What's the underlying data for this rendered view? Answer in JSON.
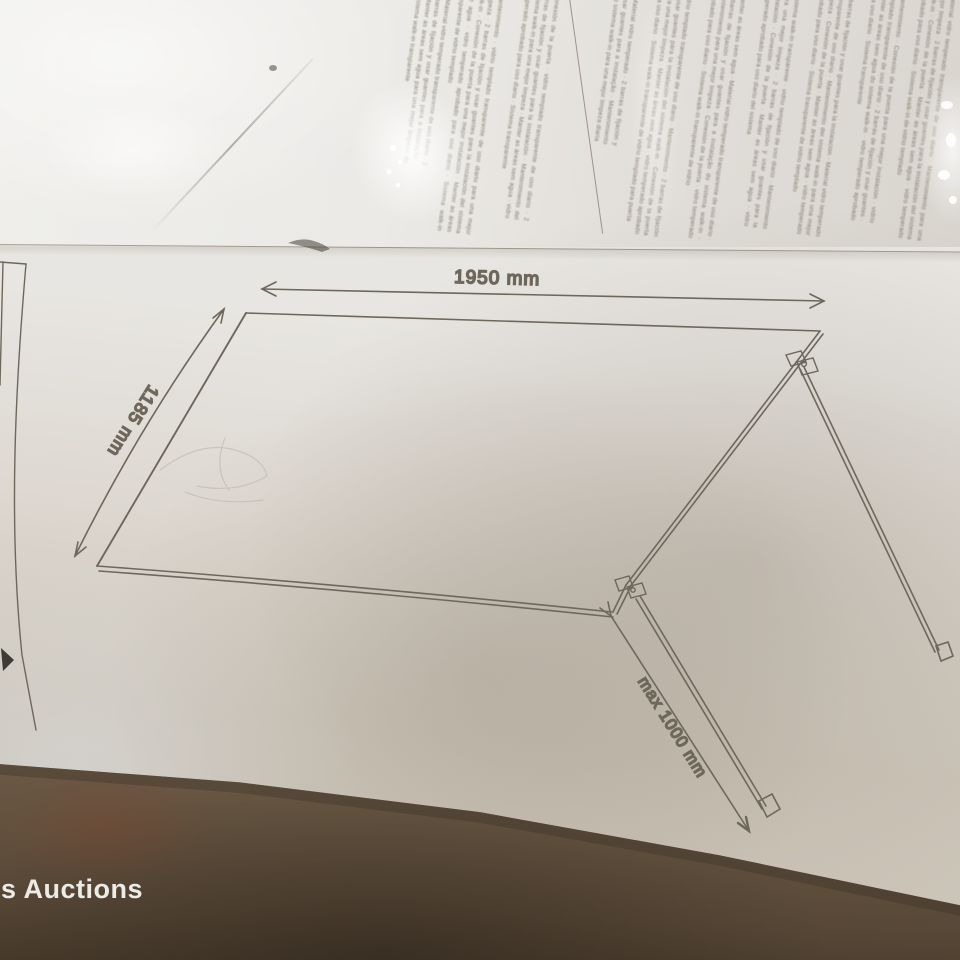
{
  "watermark": {
    "text": "s Auctions"
  },
  "diagram": {
    "width_dimension": "1950 mm",
    "side_dimension": "1185 mm",
    "support_bar_dimension": "max 1000 mm"
  },
  "instructions": {
    "columns": [
      "Material vidro temperado transparente de uso diario · 2 barras de fijación y usar guantes para a instalação · Manter as áreas sem agua para una mejor limpeza do sistema walk-in transparente",
      "Mantenimiento · vidrio templado transparente de uso diario para una mejor limpeza · 2 barras de fijación y usar guantes para la instalación del sistema walk-in · Conexión de la puerta para una mejor instalación · Manter as áreas sem agua · vidro temperado aprobado para uso diario · Sistema walk-in transparente de vidrio templado",
      "Conexión de la puerta · vidrio templado transparente de uso diario · 2 barras de fijación y usar guantes para la instalación · Mantenimiento del sistema walk-in para una mejor limpeza · Manter as áreas sem agua · vidro temperado aprobado para uso diario · Sistema transparente",
      "Material vidro temperado · 2 barras de fijación y usar guantes para a instalação · Mantenimiento do sistema walk-in para una mejor limpeza diaria",
      "vidrio templado transparente de uso diario · Mantenimiento · 2 barras de fijación y usar guantes para la instalación del sistema walk-in · Conexión de la puerta para una mejor limpeza · Manter as áreas sem agua · vidro temperado aprobado para uso diario · Sistema walk-in transparente de vidrio templado para puerta",
      "Manter as áreas sem agua · Material vidro temperado transparente de uso diario · 2 barras de fijación y usar guantes para a instalação do sistema walk-in · Mantenimiento para una mejor limpeza · Conexión de la puerta · vidro temperado aprobado para uso diario · Sistema walk-in transparente de vidrio",
      "Sistema walk-in transparente · vidrio templado de uso diario · Mantenimiento para una mejor limpeza · 2 barras de fijación y usar guantes para la instalación · Conexión de la puerta · Manter as áreas sem agua · vidro temperado aprobado para uso diario del sistema",
      "2 barras de fijación y usar guantes para la instalación · Material vidro temperado transparente de uso diario · Mantenimiento del sistema walk-in para una mejor limpeza · Conexión de la puerta · Manter as áreas sem agua · vidro temperado aprobado para uso diario · Sistema transparente de vidrio templado",
      "Mantenimiento · Conexión de la puerta para una mejor instalación · vidrio templado transparente de uso diario · 2 barras de fijación y usar guantes · Manter as áreas sem agua do sistema walk-in · vidro temperado aprobado para uso diario · Sistema transparente",
      "Material vidro temperado transparente de uso diario · Mantenimiento para una mejor limpeza · 2 barras de fijación y usar guantes para la instalación del sistema walk-in · Conexión de la puerta · Manter as áreas sem agua · vidro temperado aprobado para uso diario · Sistema walk-in de vidrio templado"
    ]
  }
}
